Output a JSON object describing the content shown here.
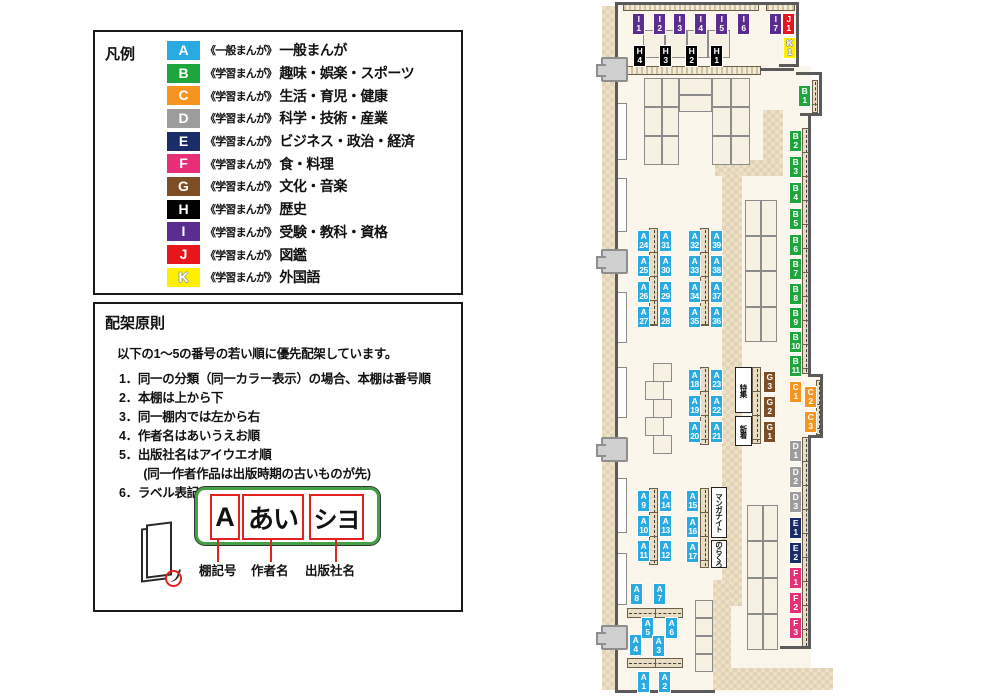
{
  "legend": {
    "title": "凡例",
    "items": [
      {
        "code": "A",
        "color": "#29abe2",
        "series": "《一般まんが》",
        "label": "一般まんが"
      },
      {
        "code": "B",
        "color": "#1ea63c",
        "series": "《学習まんが》",
        "label": "趣味・娯楽・スポーツ"
      },
      {
        "code": "C",
        "color": "#f7941e",
        "series": "《学習まんが》",
        "label": "生活・育児・健康"
      },
      {
        "code": "D",
        "color": "#9c9c9c",
        "series": "《学習まんが》",
        "label": "科学・技術・産業"
      },
      {
        "code": "E",
        "color": "#1b2d69",
        "series": "《学習まんが》",
        "label": "ビジネス・政治・経済"
      },
      {
        "code": "F",
        "color": "#e72f77",
        "series": "《学習まんが》",
        "label": "食・料理"
      },
      {
        "code": "G",
        "color": "#7d4e24",
        "series": "《学習まんが》",
        "label": "文化・音楽"
      },
      {
        "code": "H",
        "color": "#000000",
        "series": "《学習まんが》",
        "label": "歴史"
      },
      {
        "code": "I",
        "color": "#5b2d90",
        "series": "《学習まんが》",
        "label": "受験・教科・資格"
      },
      {
        "code": "J",
        "color": "#e8151d",
        "series": "《学習まんが》",
        "label": "図鑑"
      },
      {
        "code": "K",
        "color": "#fff000",
        "series": "《学習まんが》",
        "label": "外国語"
      }
    ]
  },
  "principles": {
    "title": "配架原則",
    "intro": "以下の1～5の番号の若い順に優先配架しています。",
    "rules": [
      "1．同一の分類（同一カラー表示）の場合、本棚は番号順",
      "2．本棚は上から下",
      "3．同一棚内では左から右",
      "4．作者名はあいうえお順",
      "5．出版社名はアイウエオ順",
      "　　(同一作者作品は出版時期の古いものが先)",
      "6．ラベル表記は下図の通り"
    ]
  },
  "label_example": {
    "shelf_code": "A",
    "author": "あい",
    "publisher": "シヨ",
    "captions": [
      "棚記号",
      "作者名",
      "出版社名"
    ]
  },
  "map": {
    "colors": {
      "A": "#29abe2",
      "B": "#1ea63c",
      "C": "#f7941e",
      "D": "#9c9c9c",
      "E": "#1b2d69",
      "F": "#e72f77",
      "G": "#7d4e24",
      "H": "#000000",
      "I": "#5b2d90",
      "J": "#e8151d",
      "K": "#fff000"
    },
    "floors": [
      {
        "x": 615,
        "y": 2,
        "w": 184,
        "h": 70
      },
      {
        "x": 615,
        "y": 66,
        "w": 196,
        "h": 584
      },
      {
        "x": 808,
        "y": 376,
        "w": 14,
        "h": 60
      },
      {
        "x": 615,
        "y": 648,
        "w": 196,
        "h": 44
      }
    ],
    "paths": [
      {
        "x": 602,
        "y": 6,
        "w": 13,
        "h": 684
      },
      {
        "x": 763,
        "y": 110,
        "w": 20,
        "h": 58
      },
      {
        "x": 715,
        "y": 160,
        "w": 68,
        "h": 16
      },
      {
        "x": 722,
        "y": 174,
        "w": 20,
        "h": 432
      },
      {
        "x": 713,
        "y": 580,
        "w": 18,
        "h": 90
      },
      {
        "x": 713,
        "y": 668,
        "w": 120,
        "h": 22
      }
    ],
    "windows": [
      {
        "x": 616,
        "y": 103,
        "w": 11,
        "h": 57
      },
      {
        "x": 616,
        "y": 178,
        "w": 11,
        "h": 54
      },
      {
        "x": 616,
        "y": 292,
        "w": 11,
        "h": 51
      },
      {
        "x": 616,
        "y": 367,
        "w": 11,
        "h": 51
      },
      {
        "x": 616,
        "y": 478,
        "w": 11,
        "h": 55
      },
      {
        "x": 616,
        "y": 553,
        "w": 11,
        "h": 52
      }
    ],
    "strips": [
      {
        "x": 623,
        "y": 3,
        "w": 136,
        "h": 8,
        "dir": "h",
        "hatch": true
      },
      {
        "x": 766,
        "y": 3,
        "w": 29,
        "h": 8,
        "dir": "h",
        "hatch": true
      },
      {
        "x": 625,
        "y": 66,
        "w": 136,
        "h": 9,
        "dir": "h",
        "hatch": true
      },
      {
        "x": 649,
        "y": 228,
        "w": 9,
        "h": 98,
        "dir": "v"
      },
      {
        "x": 700,
        "y": 228,
        "w": 9,
        "h": 98,
        "dir": "v"
      },
      {
        "x": 700,
        "y": 367,
        "w": 9,
        "h": 78,
        "dir": "v"
      },
      {
        "x": 649,
        "y": 488,
        "w": 9,
        "h": 77,
        "dir": "v"
      },
      {
        "x": 700,
        "y": 488,
        "w": 9,
        "h": 80,
        "dir": "v"
      },
      {
        "x": 752,
        "y": 367,
        "w": 9,
        "h": 77,
        "dir": "v"
      },
      {
        "x": 812,
        "y": 80,
        "w": 6,
        "h": 33,
        "dir": "v"
      },
      {
        "x": 802,
        "y": 128,
        "w": 7,
        "h": 246,
        "dir": "v"
      },
      {
        "x": 816,
        "y": 380,
        "w": 5,
        "h": 55,
        "dir": "v"
      },
      {
        "x": 802,
        "y": 437,
        "w": 7,
        "h": 211,
        "dir": "v"
      },
      {
        "x": 627,
        "y": 608,
        "w": 56,
        "h": 10,
        "dir": "h"
      },
      {
        "x": 627,
        "y": 658,
        "w": 56,
        "h": 10,
        "dir": "h"
      }
    ],
    "tables": [
      {
        "x": 643,
        "y": 30,
        "w": 87,
        "h": 28,
        "r": 1,
        "c": 4
      },
      {
        "x": 644,
        "y": 78,
        "w": 35,
        "h": 87,
        "r": 3,
        "c": 2
      },
      {
        "x": 679,
        "y": 78,
        "w": 33,
        "h": 34,
        "r": 2,
        "c": 1
      },
      {
        "x": 712,
        "y": 78,
        "w": 38,
        "h": 87,
        "r": 3,
        "c": 2
      },
      {
        "x": 745,
        "y": 200,
        "w": 32,
        "h": 142,
        "r": 4,
        "c": 2
      },
      {
        "x": 747,
        "y": 505,
        "w": 31,
        "h": 145,
        "r": 4,
        "c": 2
      },
      {
        "x": 653,
        "y": 363,
        "w": 19,
        "h": 19,
        "r": 1,
        "c": 1
      },
      {
        "x": 645,
        "y": 381,
        "w": 19,
        "h": 19,
        "r": 1,
        "c": 1
      },
      {
        "x": 653,
        "y": 399,
        "w": 19,
        "h": 19,
        "r": 1,
        "c": 1
      },
      {
        "x": 645,
        "y": 417,
        "w": 19,
        "h": 19,
        "r": 1,
        "c": 1
      },
      {
        "x": 653,
        "y": 435,
        "w": 19,
        "h": 19,
        "r": 1,
        "c": 1
      },
      {
        "x": 695,
        "y": 600,
        "w": 18,
        "h": 72,
        "r": 4,
        "c": 1
      }
    ],
    "walls": [
      {
        "x": 615,
        "y": 2,
        "w": 184,
        "h": 3
      },
      {
        "x": 615,
        "y": 2,
        "w": 3,
        "h": 691
      },
      {
        "x": 615,
        "y": 690,
        "w": 100,
        "h": 3
      },
      {
        "x": 796,
        "y": 2,
        "w": 3,
        "h": 65
      },
      {
        "x": 779,
        "y": 64,
        "w": 20,
        "h": 3
      },
      {
        "x": 760,
        "y": 68,
        "w": 34,
        "h": 3
      },
      {
        "x": 796,
        "y": 72,
        "w": 26,
        "h": 3
      },
      {
        "x": 819,
        "y": 72,
        "w": 3,
        "h": 44
      },
      {
        "x": 800,
        "y": 113,
        "w": 22,
        "h": 3
      },
      {
        "x": 808,
        "y": 113,
        "w": 3,
        "h": 263
      },
      {
        "x": 808,
        "y": 374,
        "w": 15,
        "h": 3
      },
      {
        "x": 820,
        "y": 374,
        "w": 3,
        "h": 64
      },
      {
        "x": 808,
        "y": 435,
        "w": 15,
        "h": 3
      },
      {
        "x": 808,
        "y": 437,
        "w": 3,
        "h": 211
      },
      {
        "x": 780,
        "y": 646,
        "w": 31,
        "h": 3
      }
    ],
    "doors": [
      {
        "x": 601,
        "y": 57
      },
      {
        "x": 601,
        "y": 249
      },
      {
        "x": 601,
        "y": 437
      },
      {
        "x": 601,
        "y": 625
      }
    ],
    "shelf_labels": [
      [
        "I1",
        632,
        13
      ],
      [
        "I2",
        653,
        13
      ],
      [
        "I3",
        673,
        13
      ],
      [
        "I4",
        694,
        13
      ],
      [
        "I5",
        715,
        13
      ],
      [
        "I6",
        737,
        13
      ],
      [
        "I7",
        769,
        13
      ],
      [
        "J1",
        782,
        13
      ],
      [
        "K1",
        783,
        37
      ],
      [
        "H4",
        633,
        45
      ],
      [
        "H3",
        659,
        45
      ],
      [
        "H2",
        685,
        45
      ],
      [
        "H1",
        710,
        45
      ],
      [
        "B1",
        798,
        85
      ],
      [
        "B2",
        789,
        130
      ],
      [
        "B3",
        789,
        156
      ],
      [
        "B4",
        789,
        182
      ],
      [
        "B5",
        789,
        208
      ],
      [
        "B6",
        789,
        234
      ],
      [
        "B7",
        789,
        258
      ],
      [
        "B8",
        789,
        283
      ],
      [
        "B9",
        789,
        307
      ],
      [
        "B10",
        789,
        331
      ],
      [
        "B11",
        789,
        355
      ],
      [
        "C1",
        789,
        381
      ],
      [
        "C2",
        804,
        386
      ],
      [
        "C3",
        804,
        411
      ],
      [
        "D1",
        789,
        440
      ],
      [
        "D2",
        789,
        466
      ],
      [
        "D3",
        789,
        491
      ],
      [
        "E1",
        789,
        517
      ],
      [
        "E2",
        789,
        542
      ],
      [
        "F1",
        789,
        567
      ],
      [
        "F2",
        789,
        592
      ],
      [
        "F3",
        789,
        617
      ],
      [
        "G3",
        763,
        371
      ],
      [
        "G2",
        763,
        396
      ],
      [
        "G1",
        763,
        421
      ],
      [
        "A24",
        637,
        230
      ],
      [
        "A31",
        659,
        230
      ],
      [
        "A25",
        637,
        255
      ],
      [
        "A30",
        659,
        255
      ],
      [
        "A26",
        637,
        281
      ],
      [
        "A29",
        659,
        281
      ],
      [
        "A27",
        637,
        306
      ],
      [
        "A28",
        659,
        306
      ],
      [
        "A32",
        688,
        230
      ],
      [
        "A39",
        710,
        230
      ],
      [
        "A33",
        688,
        255
      ],
      [
        "A38",
        710,
        255
      ],
      [
        "A34",
        688,
        281
      ],
      [
        "A37",
        710,
        281
      ],
      [
        "A35",
        688,
        306
      ],
      [
        "A36",
        710,
        306
      ],
      [
        "A18",
        688,
        369
      ],
      [
        "A23",
        710,
        369
      ],
      [
        "A19",
        688,
        395
      ],
      [
        "A22",
        710,
        395
      ],
      [
        "A20",
        688,
        421
      ],
      [
        "A21",
        710,
        421
      ],
      [
        "A9",
        637,
        490
      ],
      [
        "A14",
        659,
        490
      ],
      [
        "A10",
        637,
        515
      ],
      [
        "A13",
        659,
        515
      ],
      [
        "A11",
        637,
        540
      ],
      [
        "A12",
        659,
        540
      ],
      [
        "A15",
        686,
        490
      ],
      [
        "A16",
        686,
        516
      ],
      [
        "A17",
        686,
        541
      ],
      [
        "A8",
        630,
        583
      ],
      [
        "A7",
        653,
        583
      ],
      [
        "A5",
        641,
        617
      ],
      [
        "A6",
        665,
        617
      ],
      [
        "A4",
        629,
        634
      ],
      [
        "A3",
        652,
        635
      ],
      [
        "A1",
        637,
        671
      ],
      [
        "A2",
        658,
        671
      ]
    ],
    "notes": [
      {
        "text": "特集",
        "name": "tokushu-note",
        "x": 735,
        "y": 367,
        "w": 17,
        "h": 46
      },
      {
        "text": "新着",
        "name": "shinchaku-note",
        "x": 735,
        "y": 416,
        "w": 17,
        "h": 30
      },
      {
        "text": "マンガナイト",
        "name": "manga-night-note",
        "x": 711,
        "y": 487,
        "w": 16,
        "h": 51
      },
      {
        "text": "のらくろ",
        "name": "norakuro-note",
        "x": 711,
        "y": 540,
        "w": 16,
        "h": 28
      }
    ]
  }
}
